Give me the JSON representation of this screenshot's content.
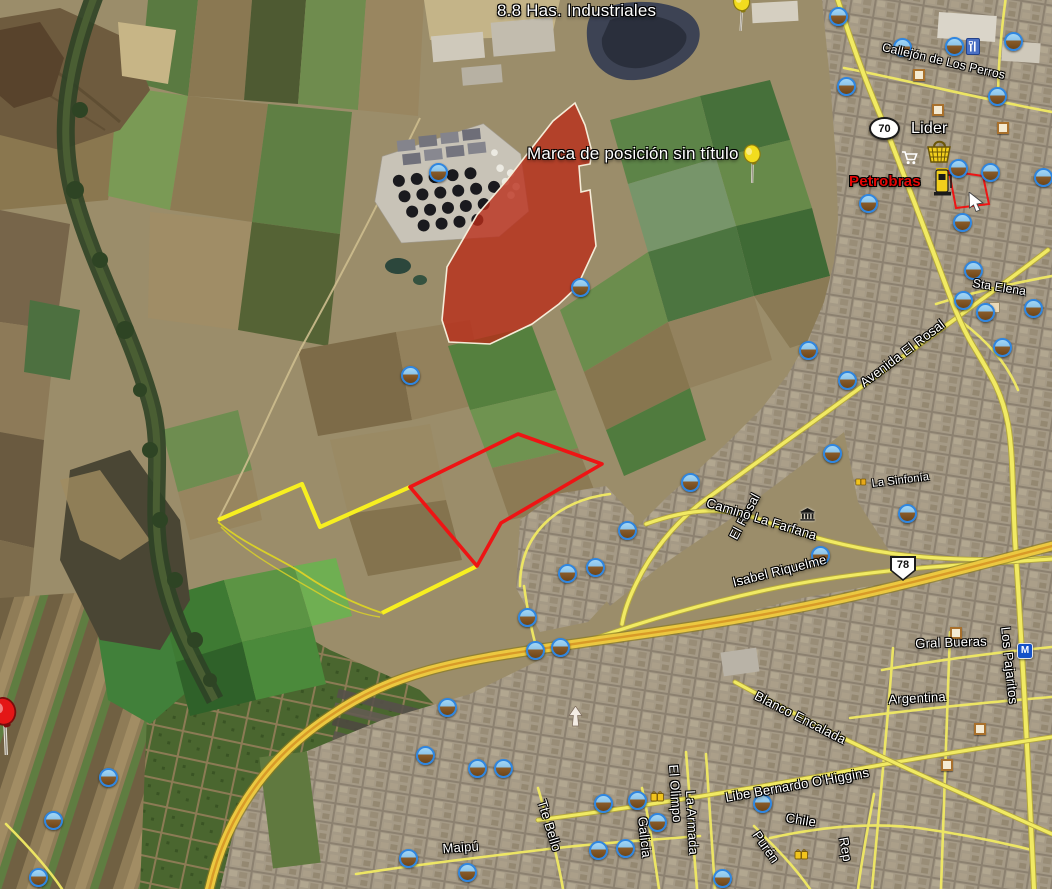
{
  "colors": {
    "parcel_outline_red": "#ee1414",
    "parcel_outline_yellow": "#f7ef20",
    "zone_fill_red": "#c03a20",
    "road_yellow": "#f1ea63",
    "highway_amber": "#ecc840"
  },
  "labels": [
    {
      "id": "has-industriales",
      "text": "8.8 Has. Industriales",
      "x": 497,
      "y": 1,
      "size": 17,
      "rot": 0,
      "inter": true
    },
    {
      "id": "marca-posicion",
      "text": "Marca de posición sin título",
      "x": 527,
      "y": 144,
      "size": 17,
      "rot": 0,
      "inter": true
    },
    {
      "id": "callejon-de-los-perros",
      "text": "Callejón de Los Perros",
      "x": 884,
      "y": 40,
      "size": 12,
      "rot": 13,
      "inter": false
    },
    {
      "id": "lider",
      "text": "Lider",
      "x": 911,
      "y": 120,
      "size": 16,
      "rot": 0,
      "inter": true
    },
    {
      "id": "petrobras",
      "text": "Petrobras",
      "x": 849,
      "y": 173,
      "size": 15,
      "rot": 0,
      "cls": "red",
      "inter": true
    },
    {
      "id": "sta-elena",
      "text": "Sta Elena",
      "x": 974,
      "y": 276,
      "size": 12,
      "rot": 9,
      "inter": false
    },
    {
      "id": "avenida-el-rosal",
      "text": "Avenida El Rosal",
      "x": 857,
      "y": 378,
      "size": 13,
      "rot": -37,
      "inter": false
    },
    {
      "id": "el-rosal",
      "text": "El Rosal",
      "x": 726,
      "y": 535,
      "size": 13,
      "rot": -62,
      "inter": false
    },
    {
      "id": "la-sinfonia",
      "text": "La Sinfonía",
      "x": 871,
      "y": 478,
      "size": 11,
      "rot": -7,
      "inter": false
    },
    {
      "id": "camino-la-farfana",
      "text": "Camino La Farfana",
      "x": 709,
      "y": 495,
      "size": 13,
      "rot": 17,
      "inter": false
    },
    {
      "id": "isabel-riquelme",
      "text": "Isabel Riquelme",
      "x": 731,
      "y": 575,
      "size": 13,
      "rot": -14,
      "inter": false
    },
    {
      "id": "gral-bueras",
      "text": "Gral Bueras",
      "x": 915,
      "y": 636,
      "size": 13,
      "rot": -2,
      "inter": false
    },
    {
      "id": "los-pajaritos",
      "text": "Los Pajaritos",
      "x": 1013,
      "y": 626,
      "size": 13,
      "rot": 84,
      "inter": false
    },
    {
      "id": "argentina",
      "text": "Argentina",
      "x": 888,
      "y": 692,
      "size": 13,
      "rot": -3,
      "inter": false
    },
    {
      "id": "blanco-encalada",
      "text": "Blanco Encalada",
      "x": 759,
      "y": 688,
      "size": 13,
      "rot": 27,
      "inter": false
    },
    {
      "id": "bernardo-ohiggins",
      "text": "Libe Bernardo O'Higgins",
      "x": 724,
      "y": 790,
      "size": 13,
      "rot": -10,
      "inter": false
    },
    {
      "id": "chile",
      "text": "Chile",
      "x": 787,
      "y": 810,
      "size": 13,
      "rot": 9,
      "inter": false
    },
    {
      "id": "puren",
      "text": "Purén",
      "x": 762,
      "y": 828,
      "size": 13,
      "rot": 55,
      "inter": false
    },
    {
      "id": "rep",
      "text": "Rep",
      "x": 851,
      "y": 836,
      "size": 13,
      "rot": 80,
      "inter": false
    },
    {
      "id": "el-olimpo",
      "text": "El Olimpo",
      "x": 681,
      "y": 764,
      "size": 13,
      "rot": 86,
      "inter": false
    },
    {
      "id": "la-armada",
      "text": "La Armada",
      "x": 698,
      "y": 790,
      "size": 13,
      "rot": 87,
      "inter": false
    },
    {
      "id": "galicia",
      "text": "Galicia",
      "x": 650,
      "y": 816,
      "size": 13,
      "rot": 84,
      "inter": false
    },
    {
      "id": "tte-bello",
      "text": "Tte Bello",
      "x": 549,
      "y": 798,
      "size": 13,
      "rot": 73,
      "inter": false
    },
    {
      "id": "maipu",
      "text": "Maipú",
      "x": 442,
      "y": 841,
      "size": 13,
      "rot": -4,
      "inter": false
    }
  ],
  "shields": [
    {
      "text": "70",
      "shape": "oval",
      "x": 869,
      "y": 117
    },
    {
      "text": "78",
      "shape": "badge",
      "x": 890,
      "y": 556
    }
  ],
  "icons": {
    "metro_label": "M",
    "photo_positions": [
      [
        838,
        16
      ],
      [
        902,
        47
      ],
      [
        954,
        46
      ],
      [
        1013,
        41
      ],
      [
        846,
        86
      ],
      [
        997,
        96
      ],
      [
        868,
        203
      ],
      [
        958,
        168
      ],
      [
        990,
        172
      ],
      [
        1043,
        177
      ],
      [
        962,
        222
      ],
      [
        973,
        270
      ],
      [
        963,
        300
      ],
      [
        985,
        312
      ],
      [
        1033,
        308
      ],
      [
        1002,
        347
      ],
      [
        438,
        172
      ],
      [
        580,
        287
      ],
      [
        410,
        375
      ],
      [
        808,
        350
      ],
      [
        847,
        380
      ],
      [
        832,
        453
      ],
      [
        690,
        482
      ],
      [
        907,
        513
      ],
      [
        820,
        555
      ],
      [
        527,
        617
      ],
      [
        535,
        650
      ],
      [
        560,
        647
      ],
      [
        447,
        707
      ],
      [
        425,
        755
      ],
      [
        477,
        768
      ],
      [
        503,
        768
      ],
      [
        603,
        803
      ],
      [
        637,
        800
      ],
      [
        657,
        822
      ],
      [
        598,
        850
      ],
      [
        625,
        848
      ],
      [
        722,
        878
      ],
      [
        762,
        803
      ],
      [
        408,
        858
      ],
      [
        467,
        872
      ],
      [
        567,
        573
      ],
      [
        595,
        567
      ],
      [
        627,
        530
      ],
      [
        108,
        777
      ],
      [
        53,
        820
      ],
      [
        38,
        877
      ]
    ],
    "square_positions": [
      [
        919,
        75
      ],
      [
        938,
        110
      ],
      [
        1003,
        128
      ],
      [
        956,
        633
      ],
      [
        980,
        729
      ],
      [
        947,
        765
      ]
    ]
  },
  "pins": [
    {
      "name": "placemark-pin-industriales",
      "x": 731,
      "y": -8,
      "rot": -10,
      "scale": 1,
      "color": "#f2dc1e",
      "edge": "#8a7a10"
    },
    {
      "name": "placemark-pin-untitled",
      "x": 742,
      "y": 144,
      "rot": -12,
      "scale": 1,
      "color": "#f2dc1e",
      "edge": "#8a7a10"
    },
    {
      "name": "placemark-pin-red",
      "x": -4,
      "y": 708,
      "rot": -16,
      "scale": 1.5,
      "color": "#e41616",
      "edge": "#7a0c0c"
    }
  ]
}
